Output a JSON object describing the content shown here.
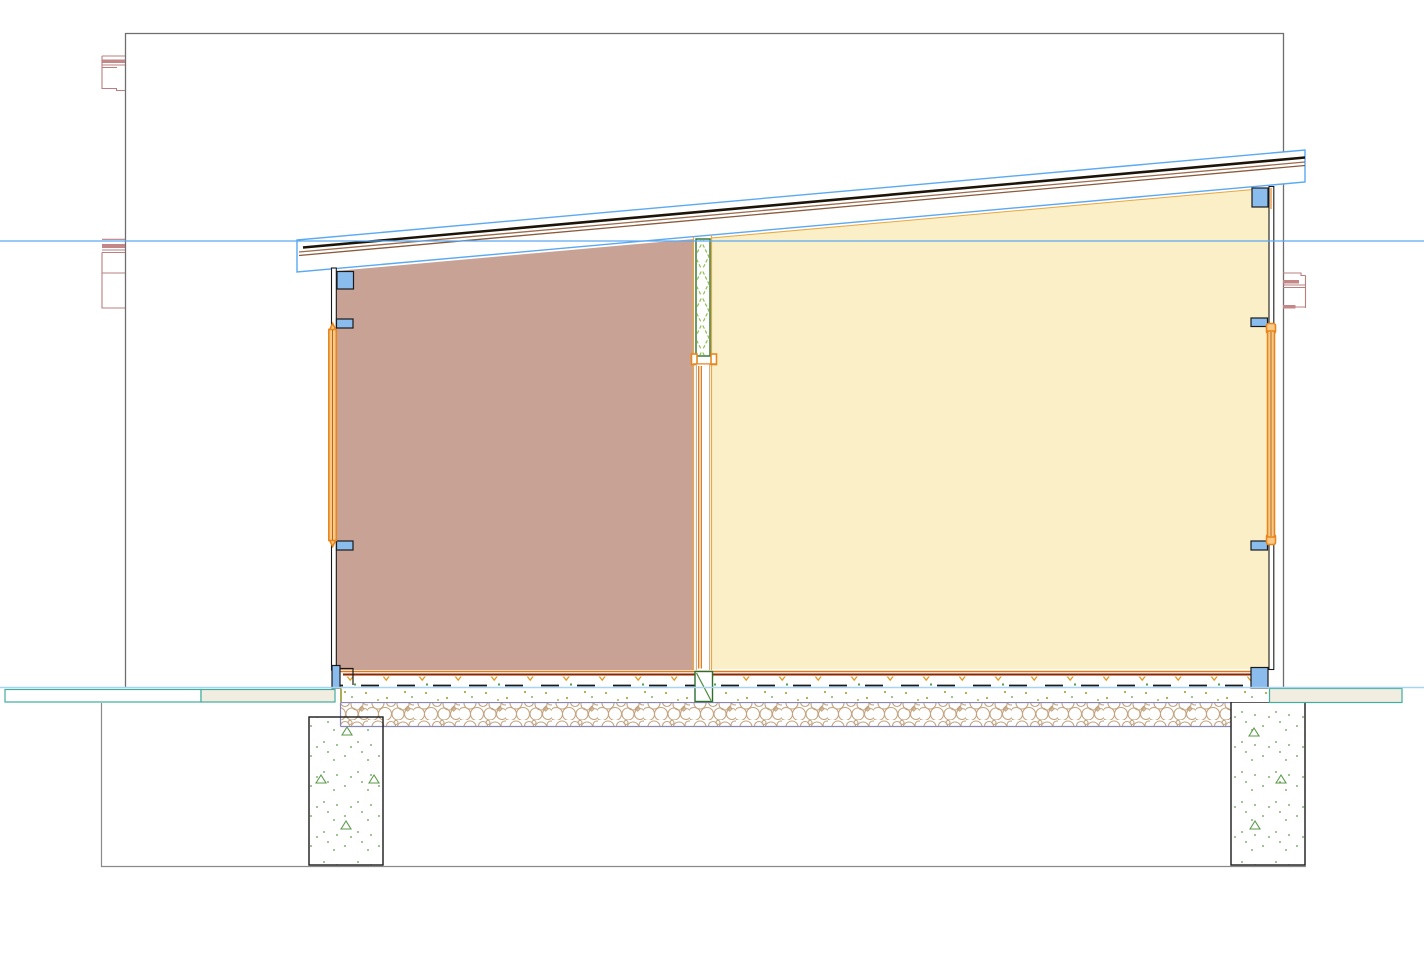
{
  "view": {
    "kind": "cad-section-view",
    "description": "Architectural cross-section of a single-storey shed-roof building: sloped roof build-up rising left-to-right, brown room left of an insulated partition, pale-yellow room right, window frames in both end walls, layered floor slab on gravel bed, two concrete strip footings, datum level line and terrain line.",
    "width_px": 1424,
    "height_px": 959,
    "visible_text": []
  },
  "palette": {
    "bg": "#ffffff",
    "border-gray": "#6e6e6e",
    "excavation-gray": "#8a8a8a",
    "datum-blue": "#5aa9f2",
    "terrain-blue": "#a9d3f2",
    "roof-blue": "#5aa9f2",
    "roofing-black": "#1c1408",
    "roof-brown1": "#9c6b4c",
    "roof-brown2": "#8a5a3c",
    "red-detail": "#b97f7f",
    "red-detail-fill": "#c38787",
    "room-left": "#c8a294",
    "room-right": "#fbefc8",
    "room-right-top": "#e8a843",
    "blue-block": "#8abded",
    "outline-dark": "#1a1a1a",
    "frame-orange": "#e8861e",
    "frame-fill": "#f9c985",
    "frame-core": "#b06a28",
    "wall-face": "#e8a843",
    "door-orange": "#e07818",
    "door-brown": "#c09060",
    "floor-orange": "#e07818",
    "floor-darkred": "#8b2500",
    "v-orange": "#e09a20",
    "dot-olive": "#9a9a20",
    "dot-green": "#5a9a4a",
    "green-dark": "#2d6e2d",
    "green-light": "#8cc050",
    "gravel-tan": "#c4a480",
    "gravel-border": "#8787b8",
    "teal": "#3fae9e",
    "beige": "#f2ede1",
    "olive-line": "#8a8a10"
  },
  "components": {
    "viewport_border": "section view crop boundary",
    "datum_line": "horizontal level line at y=241",
    "terrain_line": "horizontal grade line at y=687",
    "roof": "mono-pitch roof element, left eave low, right eave high",
    "room_left": "cut room fill, rosy brown",
    "room_right": "cut room fill, pale yellow",
    "partition_wall": "center wall with green cross-hatched insulation and door below",
    "left_wall_frame": "orange glazing frame between blue blocking pieces",
    "right_wall_frame": "orange glazing frame between blue blocking pieces",
    "floor_slab": "finish line, screed with dash/V hatch, membrane line, dotted bedding",
    "gravel_bed": "stone-circle hatched drainage layer",
    "footing_left": "concrete footing with stipple and triangle symbols",
    "footing_right": "concrete footing with stipple and triangle symbols",
    "terrain_bands": "teal-outlined ground strips left and right of building",
    "adjacent_red_details": "thin red section fragments of adjoining construction at left and right edges"
  },
  "counts": {
    "footing_triangles_left": 4,
    "footing_triangles_right": 3,
    "blue_blocks_left_wall": 4,
    "blue_blocks_right_wall": 4
  }
}
